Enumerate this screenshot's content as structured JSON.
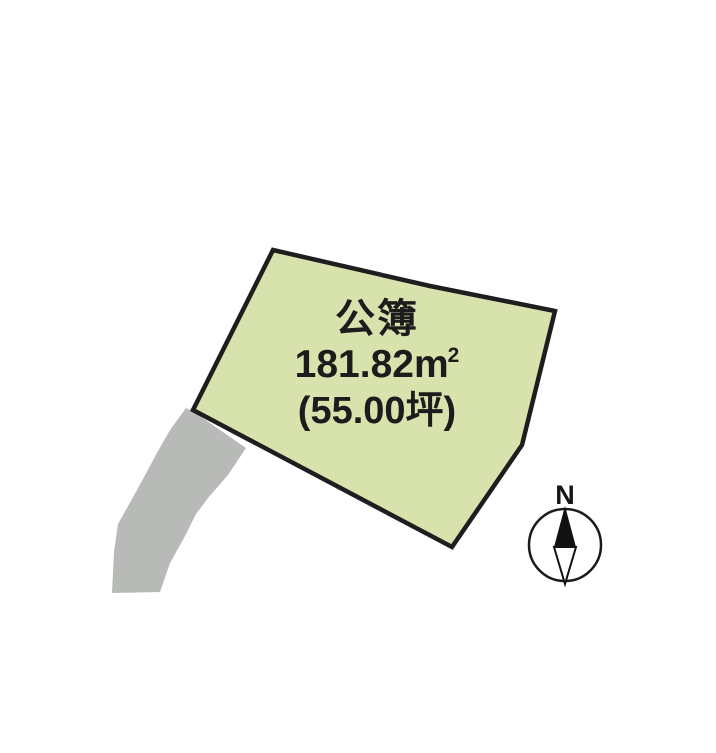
{
  "canvas": {
    "background": "#ffffff"
  },
  "parcel": {
    "register_label": "公簿",
    "area_value": "181.82",
    "area_unit": "m",
    "area_exponent": "2",
    "tsubo_text": "(55.00坪)",
    "fill_color": "#d7e2ad",
    "outline_color": "#1e1e1e"
  },
  "road": {
    "fill_color": "#b8bab7"
  },
  "compass": {
    "label": "N",
    "ring_color": "#1a1a1a",
    "needle_color": "#111111"
  }
}
